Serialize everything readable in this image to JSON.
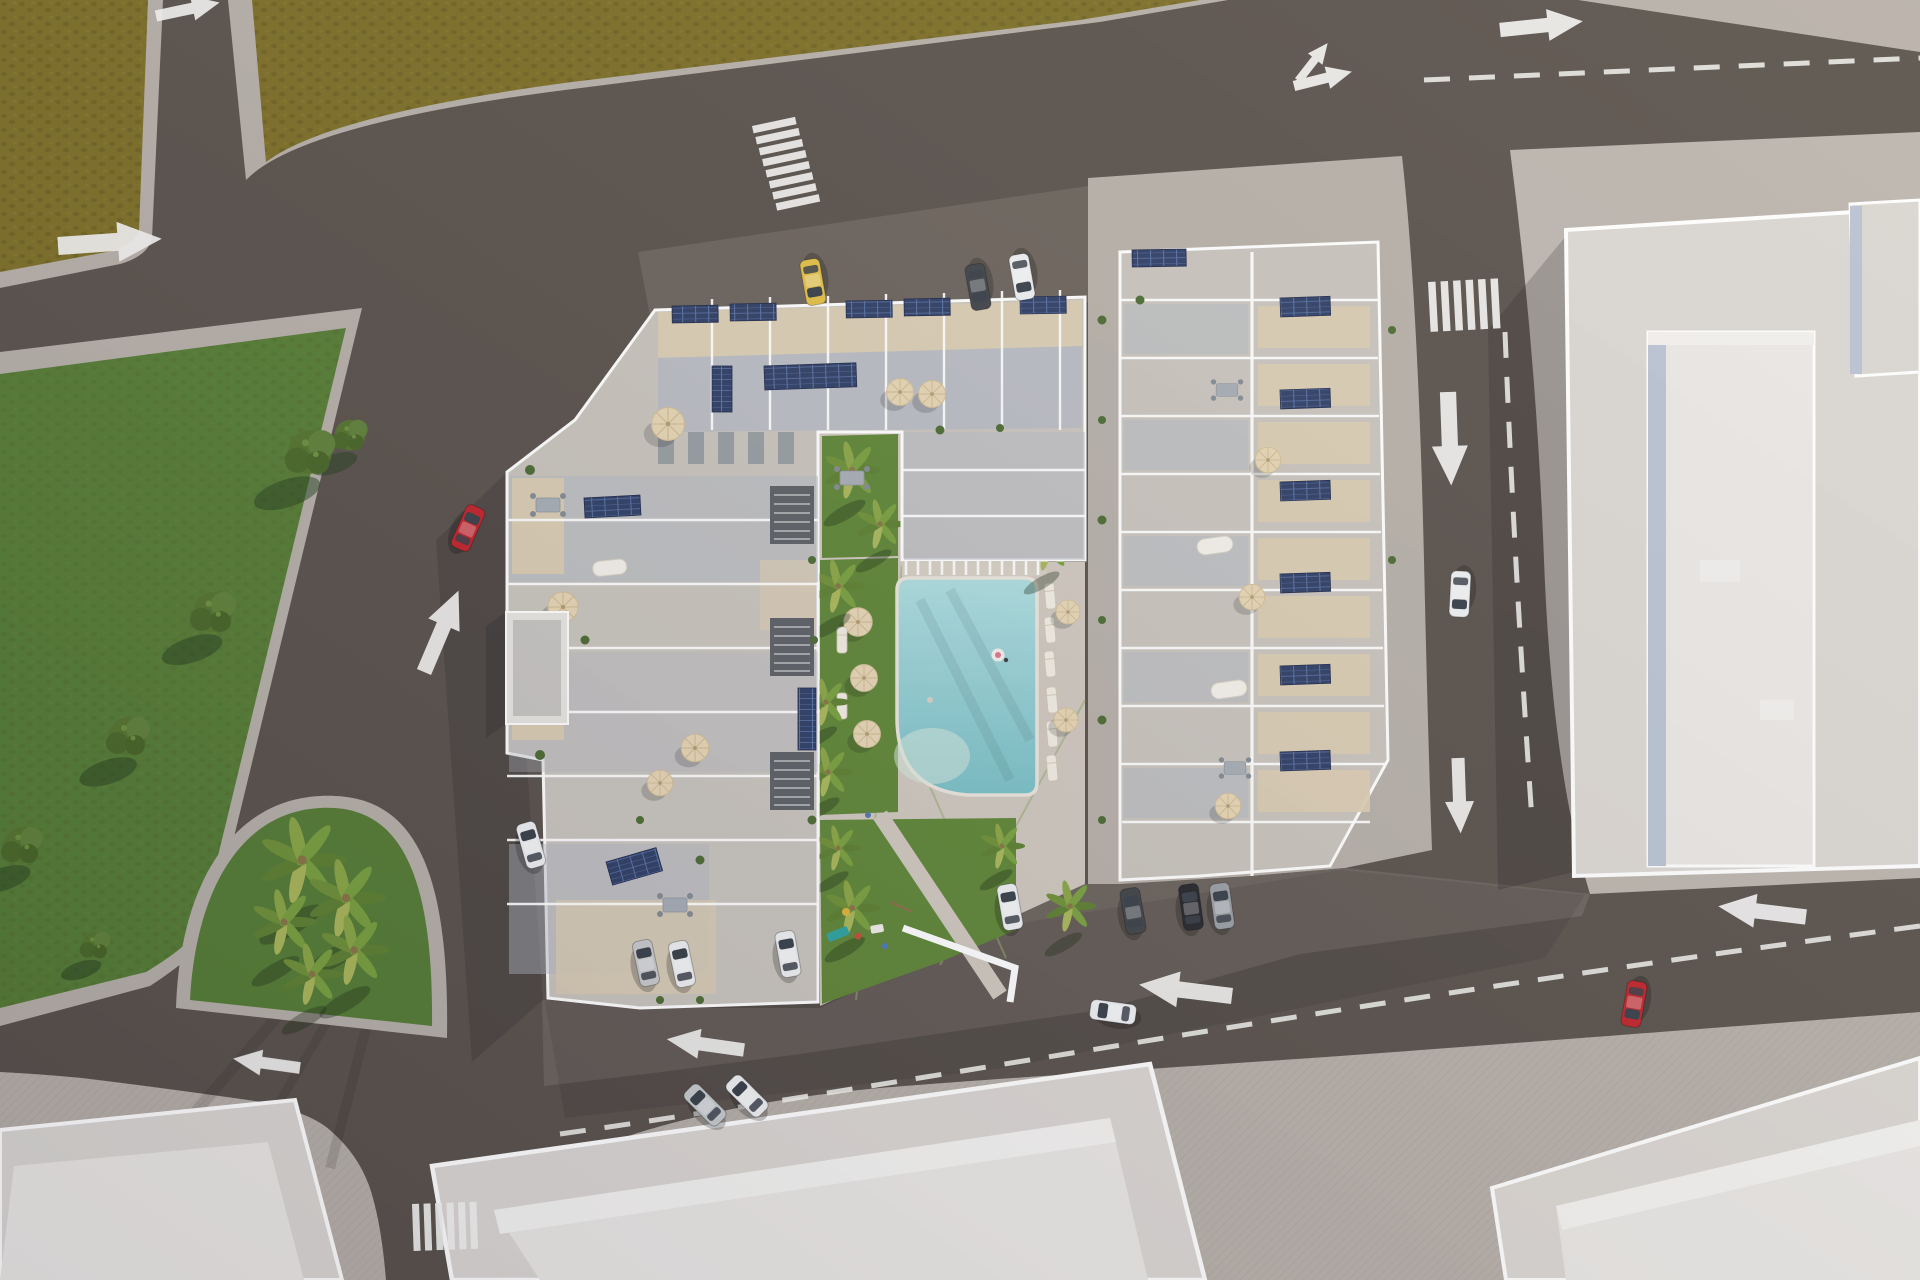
{
  "scene": {
    "title": "Aerial 3D render of residential apartment complex",
    "description": "Top-down architectural visualization: two-wing apartment complex with rooftop solar panels and terraces around a landscaped courtyard with swimming pool, lawns, palm trees and playground; surrounded by roads with white markings, a green park, a palm traffic island and neighboring light-colored buildings.",
    "lighting": "low sun from upper right, long shadows toward lower left"
  },
  "colors": {
    "road": "#5a524c",
    "sidewalk": "#b7b0a9",
    "apron": "#bcb5ae",
    "field": "#7d6e26",
    "park": "#567d35",
    "lawn": "#5f8637",
    "courtyard_floor": "#cfc8bf",
    "terrace": "#c9c4bd",
    "terrace_shade": "#b4bac6",
    "gravel": "#dbcdb3",
    "wall": "#ffffff",
    "parking": "#6b635c",
    "pool_light": "#a9dadc",
    "pool_deep": "#7cc2c8",
    "panel": "#2f3f66",
    "panel_grid": "#5973a6",
    "umbrella": "#e6d6b5",
    "marking": "#f4f3f0",
    "building": "#dbd7d3",
    "building_roof": "#ebe8e5",
    "building_face": "#bac3d4",
    "shadow": "#141420",
    "car_red": "#c0242b",
    "car_yellow": "#e2bf45",
    "car_white": "#eef0f2",
    "car_dark": "#404448"
  },
  "vehicles": [
    {
      "color": "red",
      "state": "driving",
      "location": "west road heading northeast"
    },
    {
      "color": "yellow",
      "state": "parked",
      "location": "north parking row"
    },
    {
      "color": "dark-gray",
      "state": "parked",
      "location": "north parking row"
    },
    {
      "color": "white",
      "state": "parked",
      "location": "north parking row"
    },
    {
      "color": "white",
      "state": "driving",
      "location": "east road heading south"
    },
    {
      "color": "red",
      "state": "driving",
      "location": "southeast corner turning"
    },
    {
      "color": "white",
      "state": "driving",
      "location": "south road heading west"
    },
    {
      "color": "silver",
      "state": "driving",
      "location": "south road near junction"
    },
    {
      "color": "white",
      "state": "driving",
      "location": "south road near junction"
    },
    {
      "color": "silver",
      "state": "parked",
      "location": "south side of west wing"
    },
    {
      "color": "white",
      "state": "parked",
      "location": "south side of west wing"
    },
    {
      "color": "white",
      "state": "parked",
      "location": "south side of courtyard"
    },
    {
      "color": "white",
      "state": "parked",
      "location": "south side of right wing"
    },
    {
      "color": "dark-gray",
      "state": "parked",
      "location": "south side of right wing"
    },
    {
      "color": "black",
      "state": "parked",
      "location": "south side of right wing"
    },
    {
      "color": "gray",
      "state": "parked",
      "location": "south side of right wing"
    },
    {
      "color": "white",
      "state": "parked",
      "location": "west edge bay of complex"
    }
  ],
  "road_markings": {
    "crosswalks": 3,
    "dashed_center_lines": 3,
    "arrows": {
      "right": 3,
      "left": 3,
      "up_diagonal": 2,
      "down": 2,
      "fork_straight_right": 1
    }
  },
  "site": {
    "pool": "rectangular pool with rounded southwest corner and pergola on north edge",
    "umbrellas": 14,
    "solar_panel_arrays": 17,
    "lawn_areas": 3,
    "playground": true,
    "palm_island_palms": 5,
    "park_trees": 6,
    "pergola": true,
    "garage_shed": true,
    "buildings": {
      "complex_wings": 2,
      "neighboring_buildings": 4
    }
  }
}
